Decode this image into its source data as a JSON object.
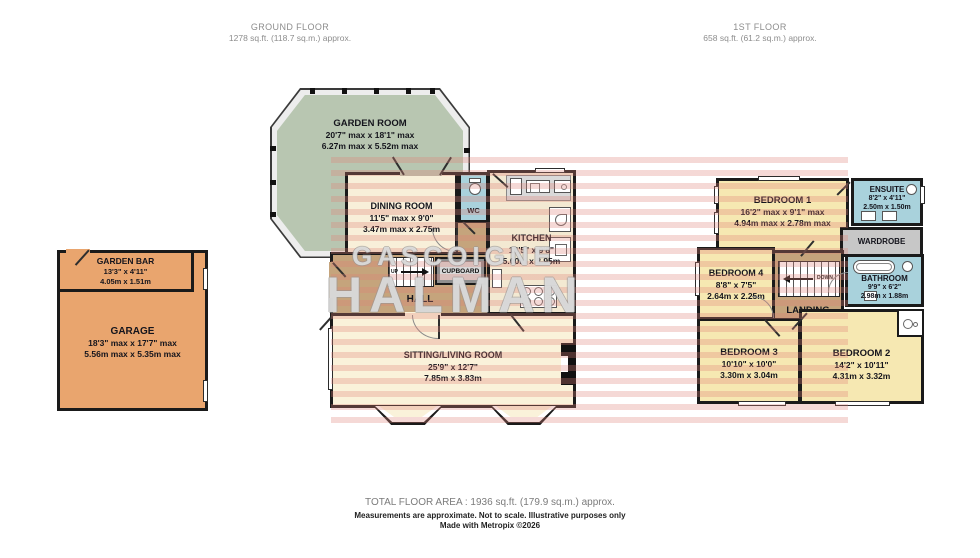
{
  "headers": {
    "ground": {
      "title": "GROUND FLOOR",
      "subtitle": "1278 sq.ft. (118.7 sq.m.) approx."
    },
    "first": {
      "title": "1ST FLOOR",
      "subtitle": "658 sq.ft. (61.2 sq.m.) approx."
    }
  },
  "rooms": {
    "garden_room": {
      "name": "GARDEN ROOM",
      "imperial": "20'7\" max x 18'1\" max",
      "metric": "6.27m max x 5.52m max"
    },
    "dining_room": {
      "name": "DINING ROOM",
      "imperial": "11'5\" max x 9'0\"",
      "metric": "3.47m max x 2.75m"
    },
    "wc": {
      "name": "WC"
    },
    "kitchen": {
      "name": "KITCHEN",
      "imperial": "16'5\" x 9'8\"",
      "metric": "5.00m x 2.95m"
    },
    "hall": {
      "name": "HALL"
    },
    "cupboard": {
      "name": "CUPBOARD"
    },
    "sitting_living": {
      "name": "SITTING/LIVING ROOM",
      "imperial": "25'9\" x 12'7\"",
      "metric": "7.85m x 3.83m"
    },
    "garden_bar": {
      "name": "GARDEN BAR",
      "imperial": "13'3\" x 4'11\"",
      "metric": "4.05m x 1.51m"
    },
    "garage": {
      "name": "GARAGE",
      "imperial": "18'3\" max x 17'7\" max",
      "metric": "5.56m max x 5.35m max"
    },
    "bedroom1": {
      "name": "BEDROOM 1",
      "imperial": "16'2\" max x 9'1\" max",
      "metric": "4.94m max x 2.78m max"
    },
    "ensuite": {
      "name": "ENSUITE",
      "imperial": "8'2\" x 4'11\"",
      "metric": "2.50m x 1.50m"
    },
    "wardrobe": {
      "name": "WARDROBE"
    },
    "bedroom4": {
      "name": "BEDROOM 4",
      "imperial": "8'8\" x 7'5\"",
      "metric": "2.64m x 2.25m"
    },
    "landing": {
      "name": "LANDING"
    },
    "bathroom": {
      "name": "BATHROOM",
      "imperial": "9'9\" x 6'2\"",
      "metric": "2.98m x 1.88m"
    },
    "bedroom3": {
      "name": "BEDROOM 3",
      "imperial": "10'10\" x 10'0\"",
      "metric": "3.30m x 3.04m"
    },
    "bedroom2": {
      "name": "BEDROOM 2",
      "imperial": "14'2\" x 10'11\"",
      "metric": "4.31m x 3.32m"
    }
  },
  "stairs": {
    "up_label": "UP",
    "down_label": "DOWN"
  },
  "watermark": {
    "line1": "GASCOIGNE",
    "line2": "HALMAN"
  },
  "footer": {
    "total_area": "TOTAL FLOOR AREA : 1936 sq.ft. (179.9 sq.m.) approx.",
    "disclaimer": "Measurements are approximate.  Not to scale.  Illustrative purposes only",
    "credit": "Made with Metropix ©2026"
  },
  "colors": {
    "wall": "#1a1a1a",
    "garden_room": "#b8c6b1",
    "cream_room": "#f8efd9",
    "hall_tan": "#c5a47c",
    "wet_room_blue": "#a9d2dc",
    "bedroom_yellow": "#f6e8b2",
    "wardrobe_gray": "#c7c7c7",
    "garage_orange": "#e9a56e",
    "watermark_stripe": "#de8076"
  }
}
